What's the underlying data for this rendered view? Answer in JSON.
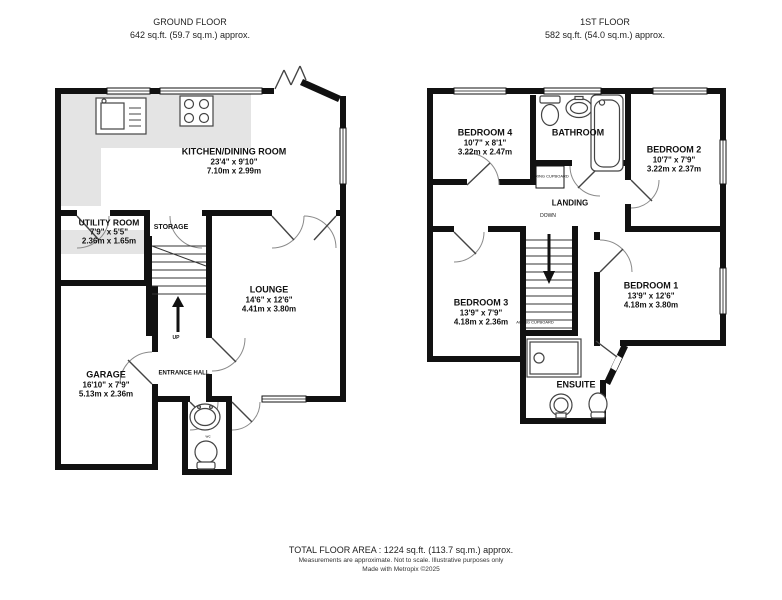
{
  "ground_floor": {
    "title": "GROUND FLOOR",
    "area": "642 sq.ft. (59.7 sq.m.) approx.",
    "rooms": {
      "kitchen": {
        "name": "KITCHEN/DINING ROOM",
        "imperial": "23'4\" x 9'10\"",
        "metric": "7.10m x 2.99m"
      },
      "utility": {
        "name": "UTILITY ROOM",
        "imperial": "7'9\" x 5'5\"",
        "metric": "2.36m x 1.65m"
      },
      "storage": {
        "name": "STORAGE"
      },
      "lounge": {
        "name": "LOUNGE",
        "imperial": "14'6\" x 12'6\"",
        "metric": "4.41m x 3.80m"
      },
      "garage": {
        "name": "GARAGE",
        "imperial": "16'10\" x 7'9\"",
        "metric": "5.13m x 2.36m"
      },
      "entrance_hall": {
        "name": "ENTRANCE HALL"
      },
      "wc": {
        "name": "wc"
      }
    },
    "stair_label": "UP"
  },
  "first_floor": {
    "title": "1ST FLOOR",
    "area": "582 sq.ft. (54.0 sq.m.) approx.",
    "rooms": {
      "bedroom4": {
        "name": "BEDROOM 4",
        "imperial": "10'7\" x 8'1\"",
        "metric": "3.22m x 2.47m"
      },
      "bathroom": {
        "name": "BATHROOM"
      },
      "bedroom2": {
        "name": "BEDROOM 2",
        "imperial": "10'7\" x 7'9\"",
        "metric": "3.22m x 2.37m"
      },
      "landing": {
        "name": "LANDING"
      },
      "bedroom3": {
        "name": "BEDROOM 3",
        "imperial": "13'9\" x 7'9\"",
        "metric": "4.18m x 2.36m"
      },
      "bedroom1": {
        "name": "BEDROOM 1",
        "imperial": "13'9\" x 12'6\"",
        "metric": "4.18m x 3.80m"
      },
      "ensuite": {
        "name": "ENSUITE"
      },
      "airing_cupboard": {
        "name": "AIRING CUPBOARD"
      },
      "cupboard": {
        "name": "AIRING CUPBOARD"
      }
    },
    "stair_label": "DOWN"
  },
  "footer": {
    "total": "TOTAL FLOOR AREA : 1224 sq.ft. (113.7 sq.m.) approx.",
    "disclaimer": "Measurements are approximate.  Not to scale.  Illustrative purposes only",
    "credit": "Made with Metropix ©2025"
  },
  "colors": {
    "wall": "#111111",
    "counter": "#e4e4e4",
    "arc": "#8a8a8a"
  }
}
